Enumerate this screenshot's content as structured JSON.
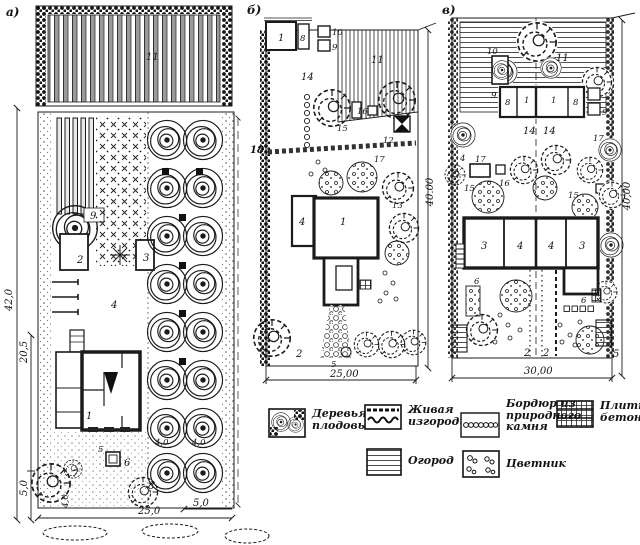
{
  "figure": {
    "title_hint": "Garden plot layout plans",
    "ink": "#1b1b1b",
    "background": "#ffffff",
    "plans": {
      "a": {
        "letter": "а)",
        "callouts": {
          "garden": "11",
          "c9": "9",
          "c2": "2",
          "c3": "3",
          "c4": "4",
          "c1": "1",
          "c5": "5",
          "c6": "6",
          "c7": "7",
          "c8": "8"
        },
        "spacing": {
          "s1": "4,0",
          "s2": "4,0",
          "s3": "4,0"
        },
        "dims": {
          "total": "42,0",
          "mid": "20,5",
          "front": "5,0",
          "width": "25,0",
          "side": "5,0"
        }
      },
      "b": {
        "letter": "б)",
        "callouts": {
          "b1": "1",
          "b8": "8",
          "b10": "10",
          "b9": "9",
          "b11": "11",
          "b14": "14",
          "b18": "18",
          "b15": "15",
          "b16": "16",
          "b12": "12",
          "b17": "17",
          "b13": "13",
          "h1": "1",
          "h4": "4",
          "b2": "2",
          "b5": "5"
        },
        "dims": {
          "width": "25,00",
          "depth": "40.00"
        }
      },
      "v": {
        "letter": "в)",
        "callouts": {
          "v10": "10",
          "v11": "11",
          "v9l": "9",
          "v8l": "8",
          "v1l": "1",
          "v1r": "1",
          "v8r": "8",
          "v9r": "9",
          "v14l": "14",
          "v14r": "14",
          "v4": "4",
          "v17l": "17",
          "v17r": "17",
          "v15l": "15",
          "v16l": "16",
          "v15r": "15",
          "v16r": "16",
          "h3l": "3",
          "h4l": "4",
          "h4r": "4",
          "h3r": "3",
          "v6l": "6",
          "v6r": "6",
          "v2l": "2",
          "v2r": "2",
          "v5": "5"
        },
        "dims": {
          "width": "30,00",
          "depth": "40,00"
        }
      }
    },
    "legend": {
      "items": [
        {
          "id": "fruit-trees",
          "label_lines": [
            "Деревья",
            "плодовые"
          ]
        },
        {
          "id": "hedge",
          "label_lines": [
            "Живая",
            "изгородь"
          ]
        },
        {
          "id": "garden",
          "label_lines": [
            "Огород"
          ]
        },
        {
          "id": "stone-border",
          "label_lines": [
            "Бордюр из",
            "природного",
            "камня"
          ]
        },
        {
          "id": "flower-garden",
          "label_lines": [
            "Цветник"
          ]
        },
        {
          "id": "concrete-tile",
          "label_lines": [
            "Плитка",
            "бетонная"
          ]
        }
      ]
    }
  }
}
